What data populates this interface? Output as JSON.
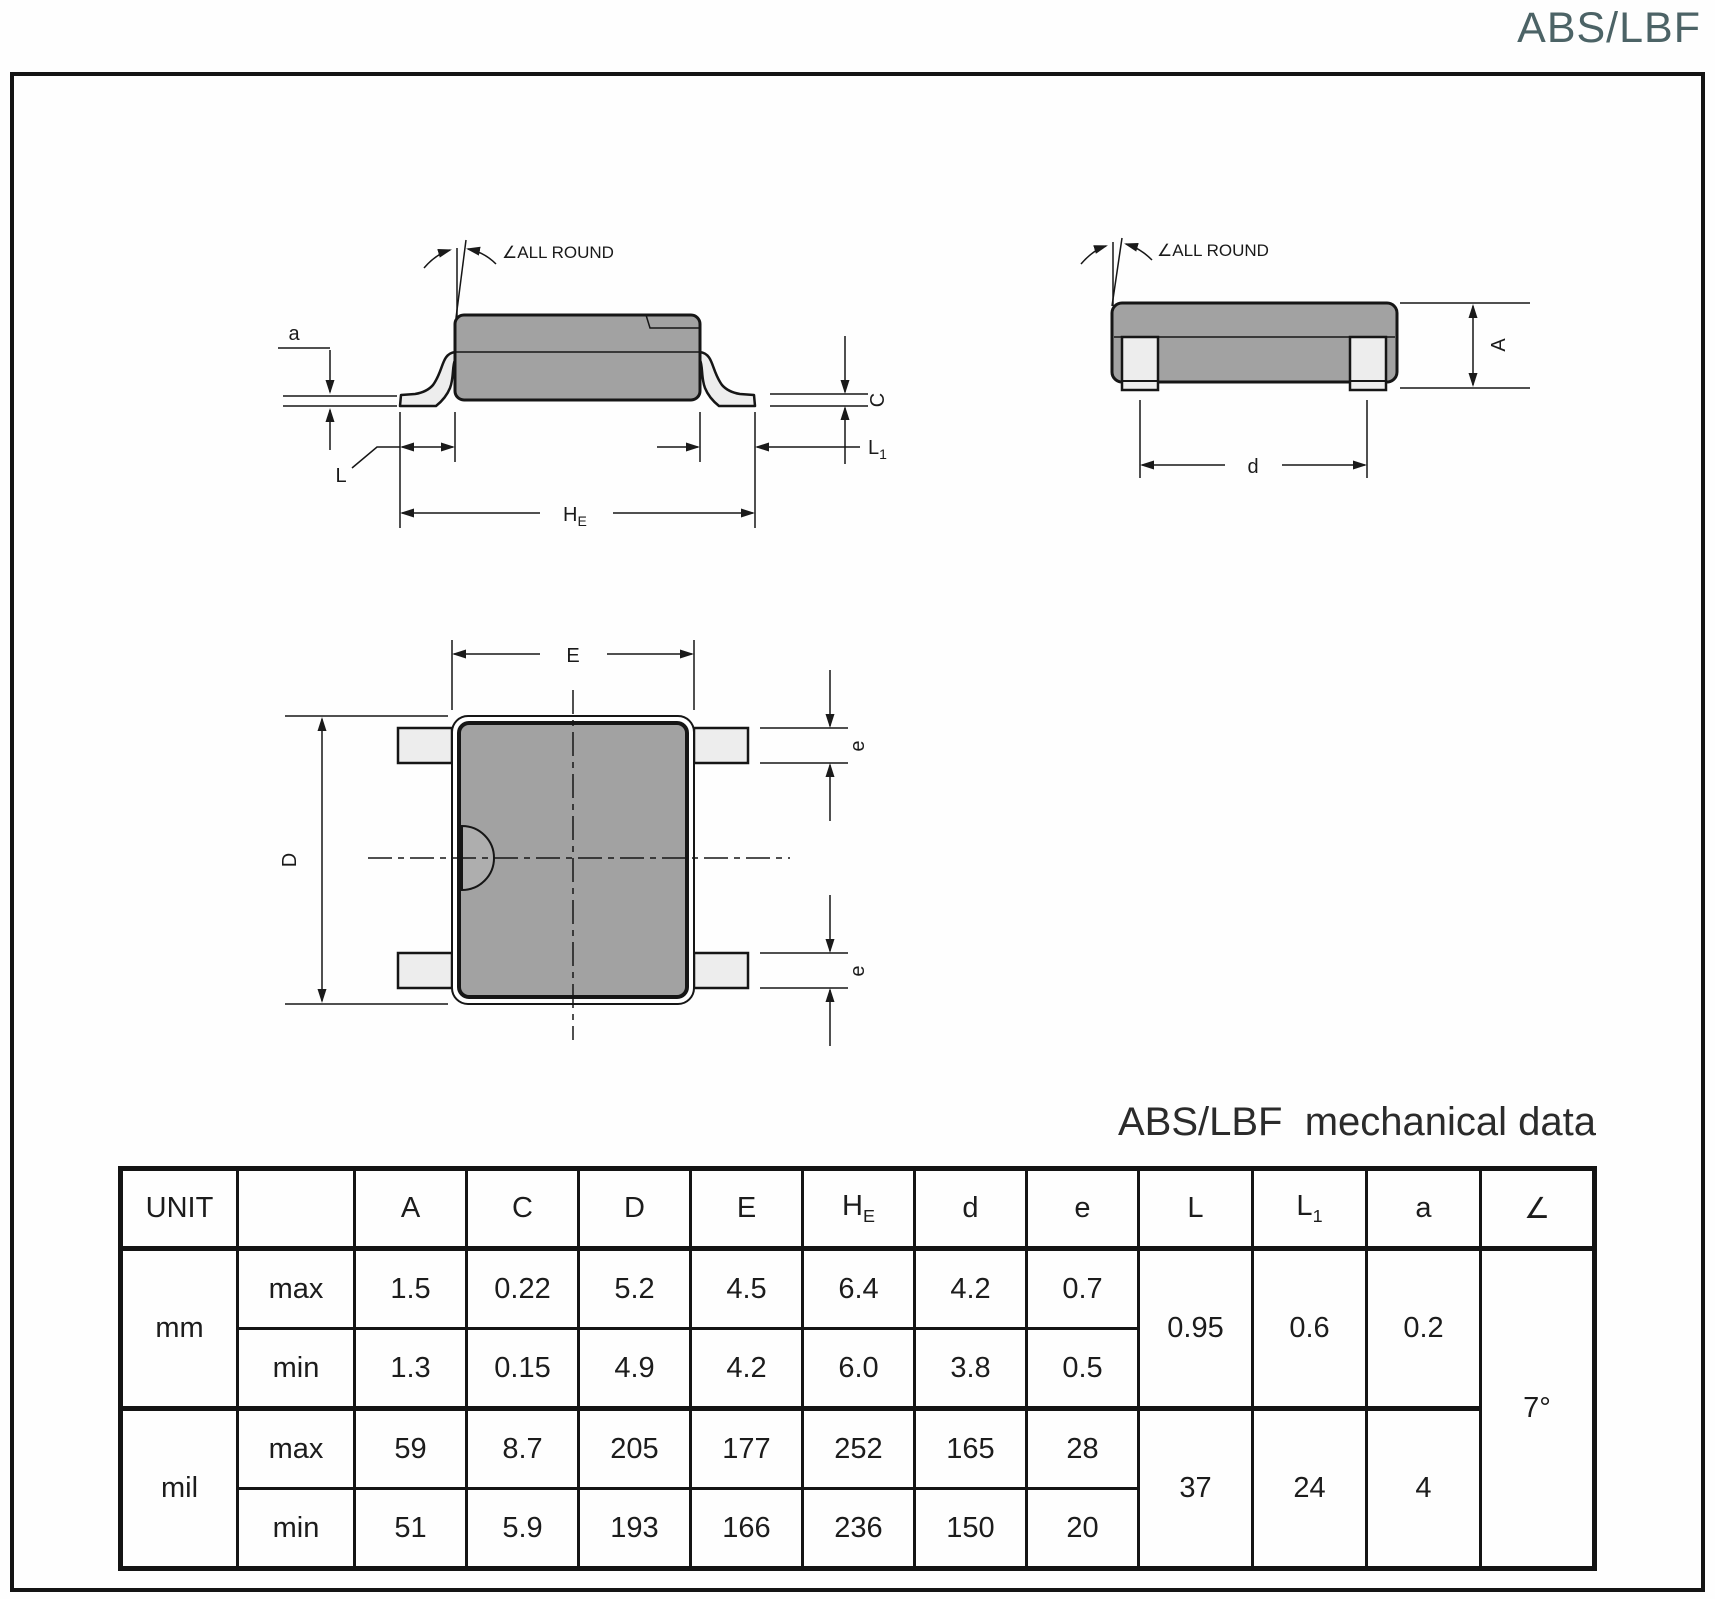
{
  "page": {
    "doc_code": "ABS/LBF",
    "table_title": "ABS/LBF  mechanical data"
  },
  "colors": {
    "accent": "#4c6366",
    "body_fill": "#a2a2a2",
    "lead_fill": "#ededed",
    "line": "#1a1a1a"
  },
  "drawings": {
    "side_view": {
      "all_round_label": "∠ALL ROUND",
      "dim_a": "a",
      "dim_c": "C",
      "dim_l": "L",
      "dim_l1_base": "L",
      "dim_l1_sub": "1",
      "dim_he_base": "H",
      "dim_he_sub": "E"
    },
    "end_view": {
      "all_round_label": "∠ALL ROUND",
      "dim_a": "A",
      "dim_d": "d"
    },
    "top_view": {
      "dim_e_top": "E",
      "dim_d": "D",
      "dim_e_right_top": "e",
      "dim_e_right_bottom": "e"
    }
  },
  "table": {
    "headers": {
      "unit": "UNIT",
      "blank": "",
      "a": "A",
      "c": "C",
      "d": "D",
      "e": "E",
      "he_base": "H",
      "he_sub": "E",
      "d_small": "d",
      "e_small": "e",
      "l": "L",
      "l1_base": "L",
      "l1_sub": "1",
      "a_small": "a",
      "angle": "∠"
    },
    "rows": {
      "mm_label": "mm",
      "mil_label": "mil",
      "mm_max_label": "max",
      "mm_min_label": "min",
      "mil_max_label": "max",
      "mil_min_label": "min",
      "mm_max": [
        "1.5",
        "0.22",
        "5.2",
        "4.5",
        "6.4",
        "4.2",
        "0.7"
      ],
      "mm_min": [
        "1.3",
        "0.15",
        "4.9",
        "4.2",
        "6.0",
        "3.8",
        "0.5"
      ],
      "mil_max": [
        "59",
        "8.7",
        "205",
        "177",
        "252",
        "165",
        "28"
      ],
      "mil_min": [
        "51",
        "5.9",
        "193",
        "166",
        "236",
        "150",
        "20"
      ],
      "mm_l": "0.95",
      "mm_l1": "0.6",
      "mm_a": "0.2",
      "mil_l": "37",
      "mil_l1": "24",
      "mil_a": "4",
      "angle_value": "7°"
    }
  }
}
